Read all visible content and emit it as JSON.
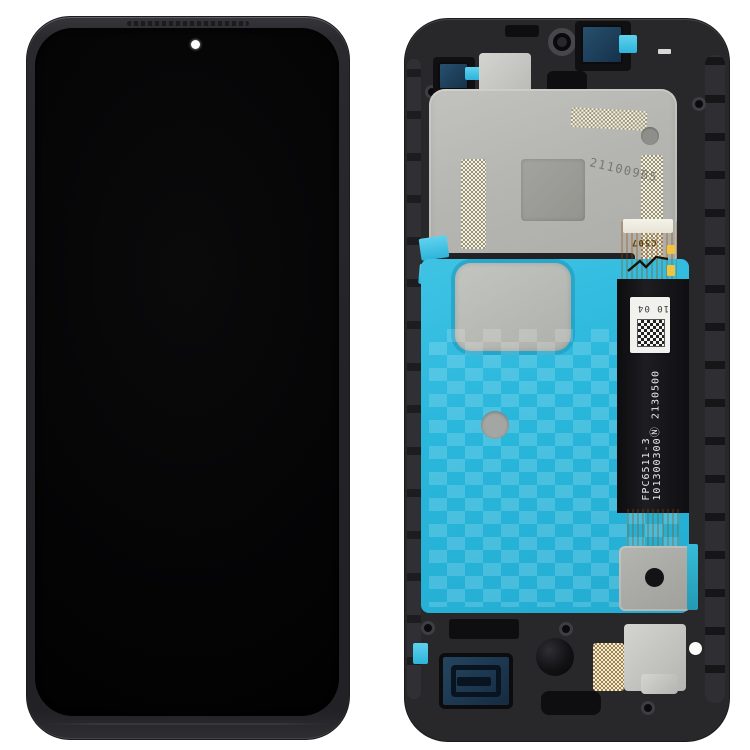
{
  "scene": {
    "type": "product-photograph",
    "subject": "Phone LCD screen and digitizer full assembly with frame - front view and back view",
    "background_color": "#ffffff"
  },
  "front_view": {
    "part": "assembled display, front glass with punch-hole camera",
    "screen_color": "#050506",
    "frame_color": "#2b2b2e",
    "punch_hole": "white-dot-camera-opening"
  },
  "back_view": {
    "part": "display rear: midframe, metal shield plate, blue adhesive film, flex cables",
    "frame_color": "#28282b",
    "shield_plate_color": "#b5b5b1",
    "adhesive_film_color": "#2bb9dd",
    "main_flex_color": "#111113",
    "connector_flex_color": "#eda03a",
    "markings": {
      "plate_etched_code": "211009B5",
      "connector_code": "C507",
      "label_code": "10 04",
      "cert_symbol": "Ⓝ",
      "cert_code": "2130500",
      "flex_part_number": "FPC6511-3",
      "flex_serial_number": "101300300"
    }
  }
}
